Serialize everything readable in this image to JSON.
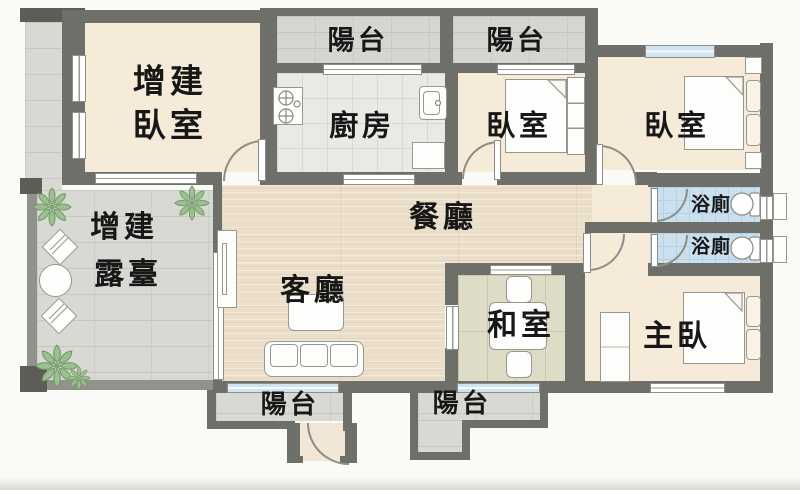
{
  "rooms": {
    "annex_bedroom": {
      "line1": "增建",
      "line2": "臥室"
    },
    "annex_terrace": {
      "line1": "增建",
      "line2": "露臺"
    },
    "balcony_top_kitchen": {
      "label": "陽台"
    },
    "balcony_top_bedroom": {
      "label": "陽台"
    },
    "kitchen": {
      "label": "廚房"
    },
    "bedroom_middle": {
      "label": "臥室"
    },
    "bedroom_right": {
      "label": "臥室"
    },
    "dining": {
      "label": "餐廳"
    },
    "living": {
      "label": "客廳"
    },
    "tatami_room": {
      "label": "和室"
    },
    "master_bedroom": {
      "label": "主臥"
    },
    "bathroom_upper": {
      "label": "浴廁"
    },
    "bathroom_lower": {
      "label": "浴廁"
    },
    "balcony_bottom_entry": {
      "label": "陽台"
    },
    "balcony_bottom_tatami": {
      "label": "陽台"
    }
  },
  "colors": {
    "wall": "#6f6f69",
    "terrace_wall": "#92928c",
    "floor_cream": "#f6ead9",
    "floor_wood": "#ebdfca",
    "floor_tile": "#d9d9d4",
    "floor_kitchen": "#e9e9e5",
    "floor_bath": "#cae0ee",
    "floor_tatami": "#dedcc6",
    "window_blue": "#cfe4f1",
    "label_text": "#171717",
    "plant_green": "#9dbf92"
  }
}
